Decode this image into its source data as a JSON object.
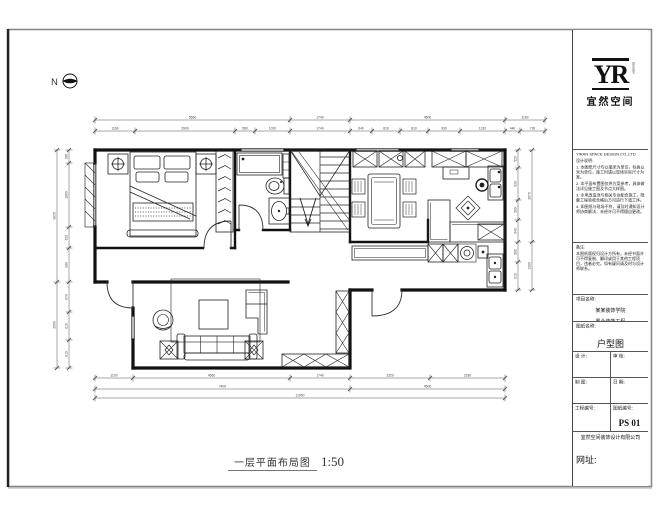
{
  "sheet": {
    "bottom_title": "一层平面布局图",
    "bottom_scale": "1:50",
    "north_label": "N"
  },
  "title_block": {
    "logo": {
      "text": "YR",
      "side_text": "DESIGN",
      "sub": "宜然空间"
    },
    "company_en": "YIRAN SPACE DESIGN CO.,LTD",
    "notes_header": "设计说明:",
    "notes": [
      "1. 本图纸尺寸均以毫米为单位，标高以米为单位，施工时请以现场实际尺寸为准。",
      "2. 本平面布置图仅供方案参考，具体做法详见施工图及节点大样图。",
      "3. 水电改造须与相关专业配合施工，隐蔽工程验收合格后方可进行下道工序。",
      "4. 如图纸与现场不符，请及时通知设计师协商解决，未经许可不得擅自更改。"
    ],
    "remark_header": "备注:",
    "remark": "本图纸版权归设计方所有，未经书面许可不得复制、翻印或用于其他工程项目，违者必究。如有疑问请及时与设计师联系。",
    "project_label": "项目名称:",
    "project_lines": [
      "某某装饰学院",
      "置业装饰工程"
    ],
    "dwg_label": "图纸名称:",
    "dwg_name": "户型图",
    "grid": {
      "r1l": "设 计:",
      "r1r": "审 核:",
      "r2l": "制 图:",
      "r2r": "日 期:",
      "r3l": "工程编号:",
      "r3r": "图纸编号:",
      "dwg_no": "PS 01"
    },
    "footer_line": "宜然空间装饰设计有限公司",
    "website_label": "网址:"
  },
  "plan": {
    "furniture_icons": [
      "double-bed",
      "nightstand-lamp",
      "wardrobe-hangers",
      "shower",
      "toilet",
      "wash-basin",
      "stair-run",
      "dining-table",
      "dining-chair",
      "kitchen-sink",
      "gas-burner",
      "floor-medallion",
      "counter-cabinet",
      "washing-machine",
      "laundry-sink",
      "rug",
      "coffee-table",
      "sofa",
      "plant-table",
      "tub-chair",
      "chaise",
      "tv-cabinet",
      "entry-door"
    ]
  },
  "dims": {
    "top_outer": [
      "5660",
      "1740",
      "4500",
      "1160"
    ],
    "top_inner": [
      "1160",
      "2900",
      "580",
      "1020",
      "1740",
      "640",
      "810",
      "810",
      "930",
      "1310",
      "440",
      "730"
    ],
    "bottom_1": [
      "1100",
      "4560",
      "1740",
      "2320",
      "2180"
    ],
    "bottom_2": [
      "7400",
      "4500"
    ],
    "bottom_3": [
      "11900"
    ],
    "left_outer": [
      "3830",
      "2500"
    ],
    "left_inner": [
      "380",
      "1860",
      "610",
      "990",
      "870",
      "810",
      "810"
    ],
    "right_inner": [
      "520",
      "930",
      "580",
      "640",
      "580",
      "810"
    ],
    "right_outer": [
      "2670",
      "1390"
    ]
  }
}
